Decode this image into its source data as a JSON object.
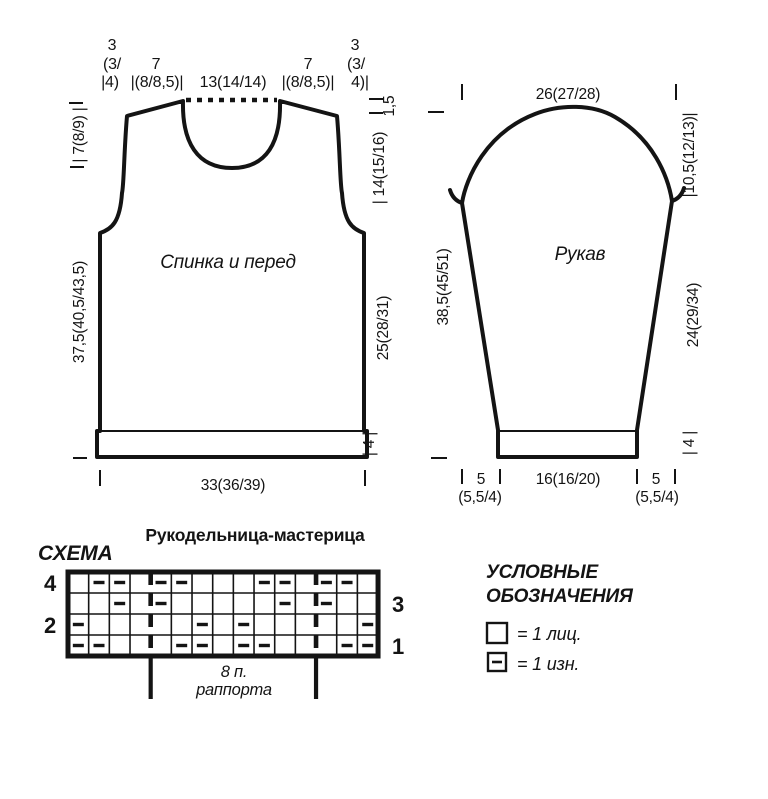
{
  "colors": {
    "ink": "#141414",
    "bg": "#ffffff"
  },
  "header": {
    "brand": "Рукодельница-мастерица"
  },
  "back_front": {
    "name": "Спинка и перед",
    "top": {
      "l3_1": "3",
      "l3_2": "(3/",
      "l3_3": "|4)",
      "l7_1": "7",
      "l7_2": "|(8/8,5)|",
      "neck": "13(14/14)",
      "r7_1": "7",
      "r7_2": "|(8/8,5)|",
      "r3_1": "3",
      "r3_2": "(3/",
      "r3_3": "4)|"
    },
    "left": {
      "armhole_top": "| 7(8/9) |",
      "side_length": "37,5(40,5/43,5)"
    },
    "right": {
      "neck_drop": "1,5",
      "armhole": "| 14(15/16)",
      "side": "25(28/31)",
      "band": "| 4 |"
    },
    "bottom_width": "33(36/39)"
  },
  "sleeve": {
    "name": "Рукав",
    "top_width": "26(27/28)",
    "left_length": "38,5(45/51)",
    "cap_height": "|10,5(12/13)|",
    "seam_length": "24(29/34)",
    "cuff_height": "| 4 |",
    "bottom": {
      "left_taper": "5",
      "left_taper_sub": "(5,5/4)",
      "cuff_width": "16(16/20)",
      "right_taper": "5",
      "right_taper_sub": "(5,5/4)"
    }
  },
  "chart": {
    "title": "СХЕМА",
    "left_row_numbers": [
      "4",
      "2"
    ],
    "right_row_numbers": [
      "3",
      "1"
    ],
    "repeat_line1": "8 п.",
    "repeat_line2": "раппорта",
    "grid": {
      "columns": 15,
      "rows": 4,
      "repeat_start_col": 5,
      "repeat_end_col": 12,
      "purl_cells": {
        "row4": [
          2,
          3,
          5,
          6,
          10,
          11,
          13,
          14
        ],
        "row3": [
          3,
          5,
          11,
          13
        ],
        "row2": [
          1,
          7,
          9,
          15
        ],
        "row1": [
          1,
          2,
          6,
          7,
          9,
          10,
          14,
          15
        ]
      }
    }
  },
  "legend": {
    "title1": "УСЛОВНЫЕ",
    "title2": "ОБОЗНАЧЕНИЯ",
    "items": [
      {
        "symbol": "knit-square",
        "label": "= 1 лиц."
      },
      {
        "symbol": "purl-square",
        "label": "= 1 изн."
      }
    ]
  }
}
